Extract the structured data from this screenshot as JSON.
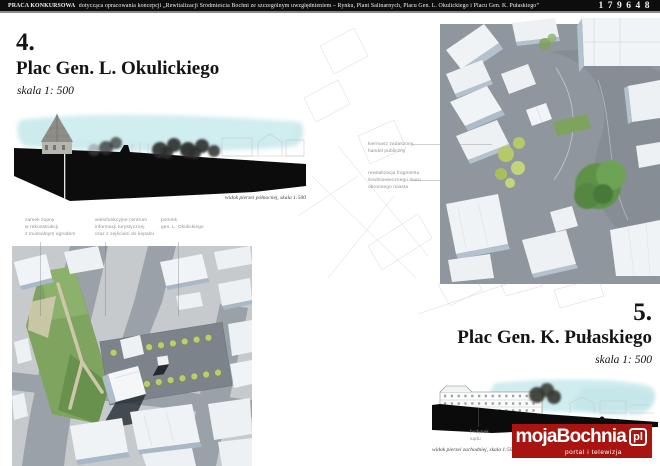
{
  "header": {
    "title_prefix": "PRACA KONKURSOWA",
    "title_rest": "dotycząca opracowania koncepcji „Rewitalizacji Śródmieścia Bochni ze szczególnym uwzględnieniem – Rynku, Plant Salinarnych, Placu Gen. L. Okulickiego i Placu Gen. K. Pułaskiego”",
    "entry_number": "179648"
  },
  "section4": {
    "number": "4.",
    "title": "Plac Gen. L. Okulickiego",
    "scale": "skala 1: 500",
    "elevation_caption": "widok pierzei północnej, skala 1:500",
    "annotations": [
      {
        "lines": [
          "zamek żupny",
          "w rekonstrukcji",
          "z muzealnym ogrodem"
        ]
      },
      {
        "lines": [
          "wielofunkcyjne centrum",
          "informacji turystycznej",
          "oraz z zejściem do kopalni"
        ]
      },
      {
        "lines": [
          "pomnik",
          "gen. L. Okulickiego"
        ]
      }
    ]
  },
  "section5": {
    "number": "5.",
    "title": "Plac Gen. K. Pułaskiego",
    "scale": "skala 1: 500",
    "elevation_caption": "widok pierzei zachodniej, skala 1:500",
    "annotations": [
      {
        "lines": [
          "kiermasz zadaszony,",
          "handel publiczny"
        ]
      },
      {
        "lines": [
          "rewitalizacja fragmentu",
          "średniowiecznego muru",
          "obronnego miasta"
        ]
      }
    ],
    "elevation_label": {
      "lines": [
        "budynek",
        "sądu"
      ]
    }
  },
  "logo": {
    "name": "mojaBochnia",
    "tld": "pl",
    "tagline": "portal i telewizja"
  },
  "colors": {
    "header_bg": "#0d0d0d",
    "watercolor_sky": "#c3e7ea",
    "silhouette_black": "#0c0c0c",
    "street_gray": "#8f969e",
    "plaza_gray": "#7c838b",
    "building_shadow_blue": "#aebccb",
    "park_green": "#7fa45f",
    "tree_green": "#5f9147",
    "young_tree_lime": "#b5c968",
    "logo_red": "#a81410",
    "annotation_gray": "#8f8f8f"
  }
}
